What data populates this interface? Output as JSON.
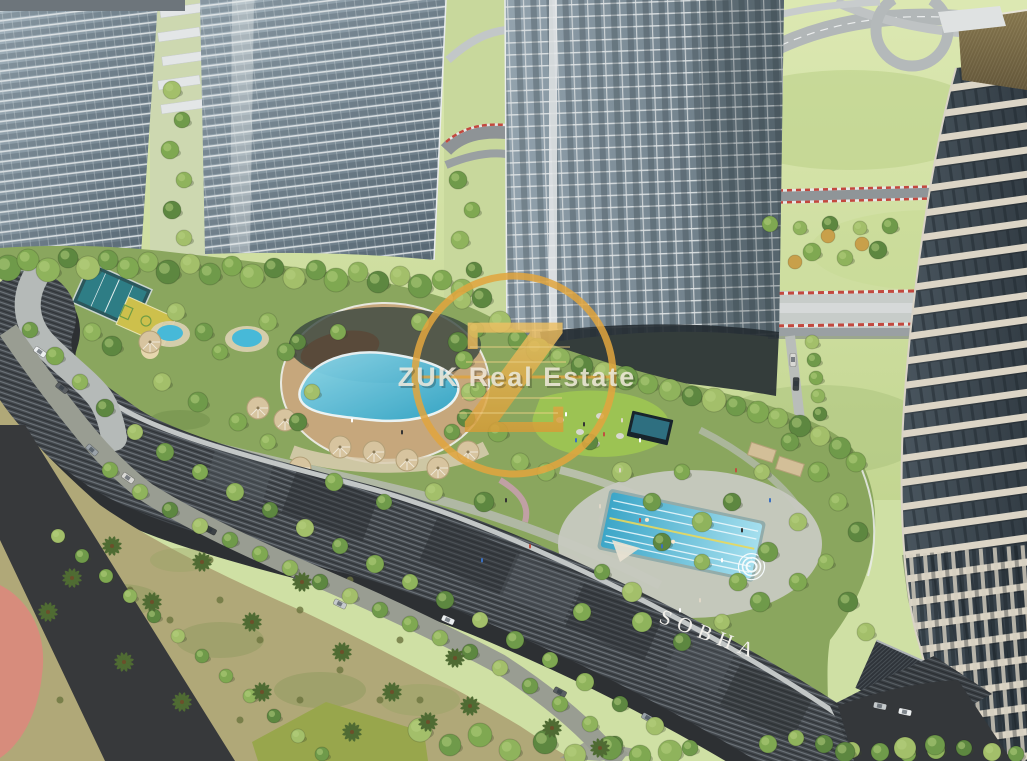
{
  "signage": {
    "podium_sign": "SOBHA"
  },
  "watermark": {
    "monogram": "Z",
    "agency_name": "ZUK Real Estate"
  },
  "colors": {
    "watermark_gold": "#E2A53E",
    "sign_white": "#F2F0EB",
    "pool_blue": "#47B9D8",
    "lawn_green": "#9CC353",
    "field_green": "#CFE0A4",
    "podium_grey": "#42474C",
    "crown_gold": "#B5954E",
    "track_red": "#C2483E",
    "path_pink": "#C99FB0",
    "salmon_deck": "#D98A7C"
  }
}
